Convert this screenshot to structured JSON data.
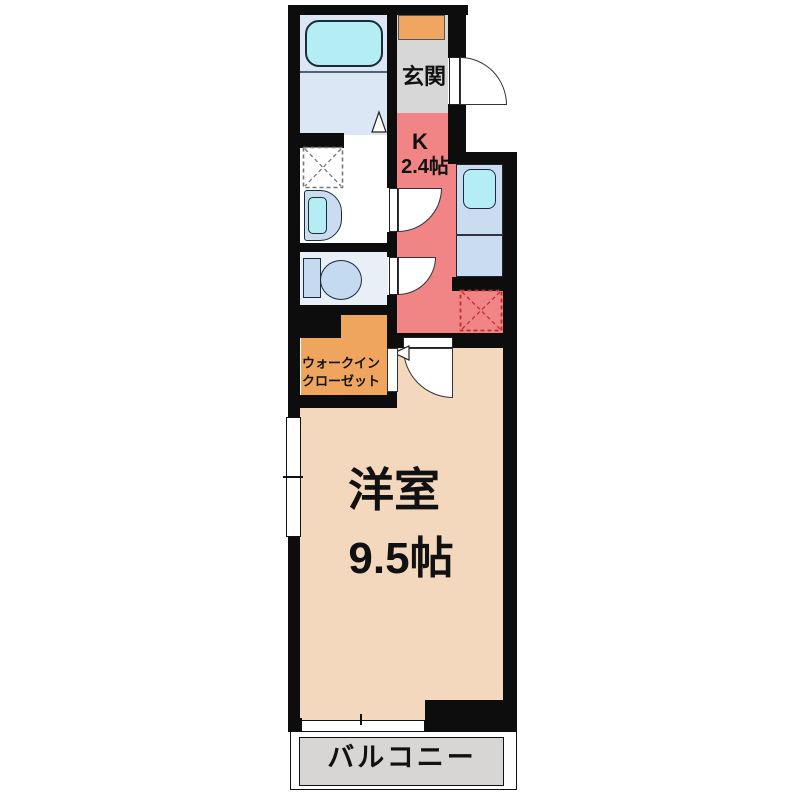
{
  "floorplan": {
    "labels": {
      "entrance": "玄関",
      "kitchen_name": "K",
      "kitchen_size": "2.4帖",
      "closet_line1": "ウォークイン",
      "closet_line2": "クローゼット",
      "main_room_name": "洋室",
      "main_room_size": "9.5帖",
      "balcony": "バルコニー"
    },
    "fixtures": [
      "bathtub",
      "bathroom-door-marker",
      "washing-machine-pan",
      "washbasin",
      "toilet",
      "kitchen-counter",
      "kitchen-sink",
      "refrigerator-space",
      "shoe-cabinet",
      "entrance-door",
      "washroom-door",
      "toilet-door",
      "main-room-door",
      "closet-opening",
      "window-left",
      "sliding-window"
    ],
    "colors": {
      "wall": "#0d0d0d",
      "bathroom_floor": "#dbe7f4",
      "bathtub": "#b4edf4",
      "entrance_floor": "#d7d7d7",
      "shoe_cabinet": "#f0a660",
      "kitchen_floor": "#f18585",
      "counter": "#c9dcf0",
      "sink": "#b4edf4",
      "washroom_floor": "#ffffff",
      "toilet_floor": "#e9eff7",
      "toilet_fixture": "#c4daf1",
      "closet_floor": "#f0a55f",
      "main_room_floor": "#f4d8be",
      "balcony_floor": "#d8d6d4",
      "fridge_dash": "#c03030"
    }
  }
}
